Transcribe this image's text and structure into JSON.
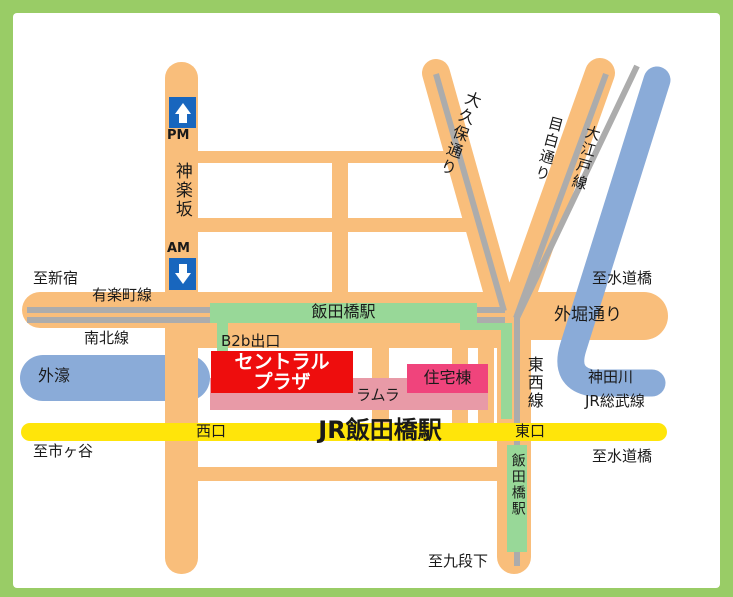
{
  "map": {
    "colors": {
      "border_green": "#99CC66",
      "road_orange": "#F9BE7B",
      "rail_gray": "#ACACAC",
      "water_blue": "#8AABD8",
      "sign_blue": "#1866BE",
      "station_green": "#98D898",
      "jr_yellow": "#FFE50A",
      "plaza_red": "#EE0D0D",
      "ramla_pink": "#E89AA7",
      "jutaku_rose": "#F0447C"
    },
    "labels": {
      "pm": "PM",
      "am": "AM",
      "kagurazaka": "神楽坂",
      "to_shinjuku": "至新宿",
      "yurakucho_line": "有楽町線",
      "namboku_line": "南北線",
      "sotobori_moat": "外濠",
      "iidabashi_station_metro": "飯田橋駅",
      "b2b_exit": "B2b出口",
      "central_plaza_line1": "セントラル",
      "central_plaza_line2": "プラザ",
      "ramla": "ラムラ",
      "jutaku_to": "住宅棟",
      "okubo_dori": "大久保通り",
      "mejiro_dori": "目白通り",
      "oedo_line": "大江戸線",
      "to_suidobashi_upper": "至水道橋",
      "sotobori_dori": "外堀通り",
      "kanda_river": "神田川",
      "jr_sobu_line": "JR総武線",
      "tozai_line": "東西線",
      "nishi_exit": "西口",
      "jr_iidabashi_station": "JR飯田橋駅",
      "higashi_exit": "東口",
      "to_suidobashi_lower": "至水道橋",
      "to_ichigaya": "至市ヶ谷",
      "to_kudanshita": "至九段下",
      "iidabashi_station_south": "飯田橋駅"
    }
  }
}
